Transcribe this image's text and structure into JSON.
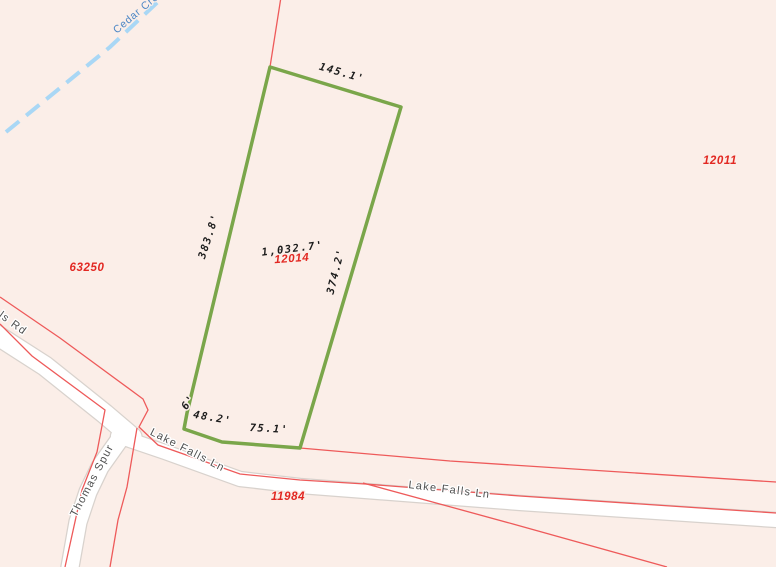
{
  "map": {
    "colors": {
      "background": "#fbeee8",
      "parcel_boundary_red": "#ee5a5a",
      "selected_parcel_green": "#7aa64a",
      "road_fill": "#ffffff",
      "road_casing": "#d8d2cd",
      "creek_blue": "#a9d7f5",
      "creek_label_blue": "#4b86c5",
      "parcel_id_red": "#e22822",
      "dimension_text": "#1c1c1c",
      "road_label_gray": "#4f4f4f"
    },
    "creek": {
      "label": "Cedar Cre",
      "label_pos": {
        "x": 138,
        "y": 16,
        "rot": -40
      },
      "points": [
        [
          6,
          132
        ],
        [
          60,
          88
        ],
        [
          110,
          47
        ],
        [
          162,
          -2
        ]
      ]
    },
    "roads": [
      {
        "name": "falls-rd",
        "width": 19,
        "points": [
          [
            -8,
            332
          ],
          [
            45,
            366
          ],
          [
            105,
            414
          ],
          [
            132,
            437
          ]
        ]
      },
      {
        "name": "lake-falls-ln",
        "width": 14,
        "points": [
          [
            118,
            436
          ],
          [
            165,
            452
          ],
          [
            240,
            479
          ],
          [
            300,
            486
          ],
          [
            365,
            491
          ],
          [
            520,
            503
          ],
          [
            776,
            520
          ]
        ]
      },
      {
        "name": "thomas-spur",
        "width": 17,
        "points": [
          [
            122,
            436
          ],
          [
            100,
            467
          ],
          [
            88,
            492
          ],
          [
            78,
            522
          ],
          [
            70,
            567
          ]
        ]
      }
    ],
    "boundaries": [
      {
        "name": "boundary-north-spur",
        "points": [
          [
            281,
            -3
          ],
          [
            270,
            67
          ]
        ]
      },
      {
        "name": "boundary-upper-road-line",
        "points": [
          [
            0,
            297
          ],
          [
            60,
            338
          ],
          [
            143,
            399
          ],
          [
            148,
            410
          ],
          [
            139,
            427
          ],
          [
            158,
            445
          ],
          [
            240,
            474
          ],
          [
            300,
            480
          ],
          [
            365,
            484
          ],
          [
            520,
            496
          ],
          [
            776,
            513
          ]
        ]
      },
      {
        "name": "boundary-parcel-south-line",
        "points": [
          [
            300,
            448
          ],
          [
            450,
            461
          ],
          [
            776,
            482
          ]
        ]
      },
      {
        "name": "boundary-diagonal-cross",
        "points": [
          [
            363,
            483
          ],
          [
            513,
            524
          ],
          [
            667,
            567
          ]
        ]
      },
      {
        "name": "boundary-road-west-edge",
        "points": [
          [
            0,
            324
          ],
          [
            32,
            356
          ],
          [
            105,
            410
          ],
          [
            97,
            452
          ],
          [
            82,
            490
          ],
          [
            65,
            567
          ]
        ]
      },
      {
        "name": "boundary-thomas-spur-east",
        "points": [
          [
            137,
            428
          ],
          [
            127,
            487
          ],
          [
            118,
            520
          ],
          [
            110,
            567
          ]
        ]
      }
    ],
    "selected_parcel": {
      "id": "12014",
      "perimeter": "1,032.7'",
      "polygon": [
        [
          270,
          67
        ],
        [
          401,
          107
        ],
        [
          300,
          448
        ],
        [
          222,
          442
        ],
        [
          184,
          429
        ],
        [
          187,
          413
        ]
      ],
      "id_label_pos": {
        "x": 292,
        "y": 262,
        "rot": -4
      },
      "perimeter_label_pos": {
        "x": 293,
        "y": 252,
        "rot": -7
      },
      "dimensions": [
        {
          "text": "145.1'",
          "x": 341,
          "y": 76,
          "rot": 16
        },
        {
          "text": "383.8'",
          "x": 212,
          "y": 237,
          "rot": -72
        },
        {
          "text": "374.2'",
          "x": 339,
          "y": 272,
          "rot": -76
        },
        {
          "text": "6'",
          "x": 191,
          "y": 404,
          "rot": -55
        },
        {
          "text": "48.2'",
          "x": 212,
          "y": 421,
          "rot": 10
        },
        {
          "text": "75.1'",
          "x": 269,
          "y": 432,
          "rot": 3
        }
      ]
    },
    "parcel_ids": [
      {
        "text": "63250",
        "x": 87,
        "y": 271
      },
      {
        "text": "12011",
        "x": 720,
        "y": 164
      },
      {
        "text": "11984",
        "x": 288,
        "y": 500
      }
    ],
    "road_labels": [
      {
        "text": "ls Rd",
        "x": 11,
        "y": 326,
        "rot": 36
      },
      {
        "text": "Thomas Spur",
        "x": 95,
        "y": 482,
        "rot": -62
      },
      {
        "text": "Lake Falls Ln",
        "x": 186,
        "y": 453,
        "rot": 27
      },
      {
        "text": "Lake Falls Ln",
        "x": 449,
        "y": 493,
        "rot": 7
      }
    ]
  }
}
